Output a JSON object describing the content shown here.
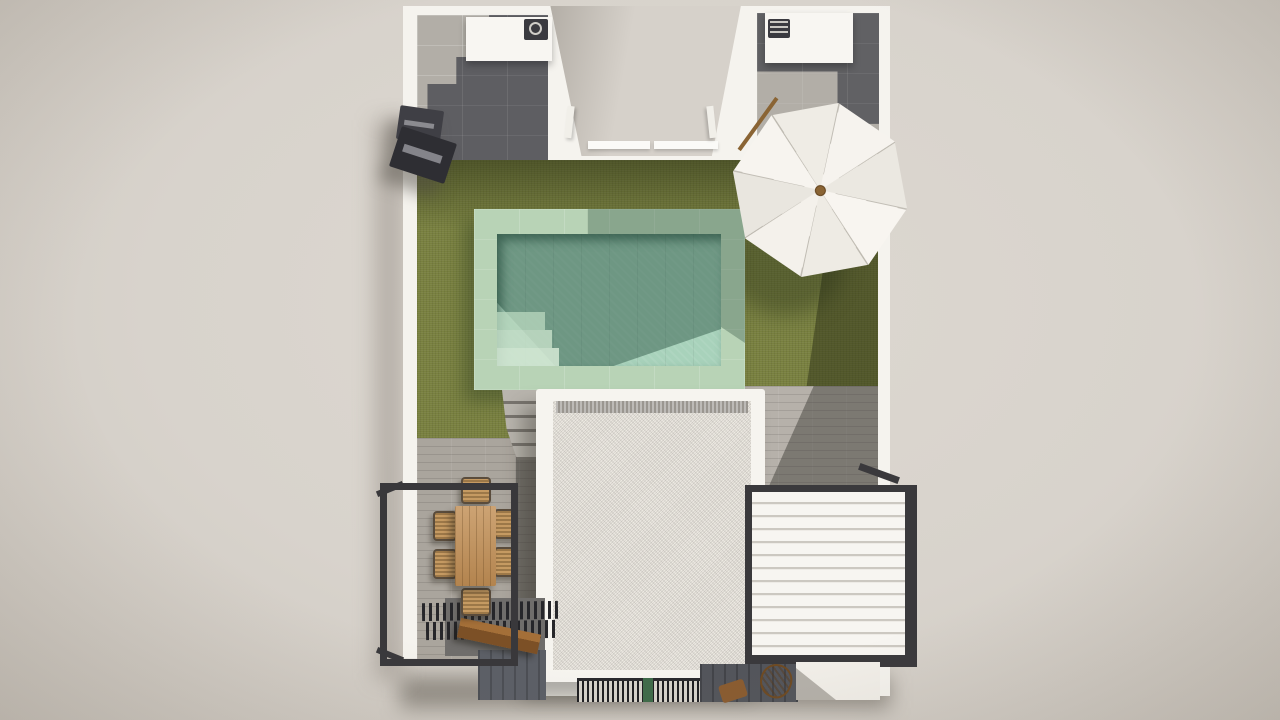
{
  "scene": {
    "type": "3d-architectural-render",
    "view": "top-down",
    "subject": "villa roof terrace with pool",
    "elements": [
      "outer-white-walls",
      "top-left-service-patio",
      "top-right-service-patio",
      "ac-unit-left",
      "ac-unit-right",
      "central-courtyard",
      "lawn",
      "swimming-pool",
      "pool-deck",
      "pool-steps",
      "parasol-umbrella",
      "garden-stairs",
      "gravel-roof",
      "left-balcony-railing",
      "dining-table",
      "dining-chairs",
      "pergola-slats",
      "wood-bench",
      "right-balcony-railing",
      "louvered-pergola",
      "floor-grate",
      "wood-stool",
      "wall-mounted-unit",
      "wood-pole"
    ],
    "counts": {
      "dining_chairs": 6,
      "umbrella_segments": 8,
      "pool_steps": 3
    }
  },
  "palette": {
    "background": "#d8d3cc",
    "wall_white": "#f5f3ee",
    "grass": "#78803f",
    "grass_shadow": "#4c5226",
    "pool_water": "#a8d2bb",
    "pool_water_shadow": "#5e8f7b",
    "pool_deck": "#b8d3b6",
    "tile_dark": "#57575c",
    "tile_light": "#b2aea7",
    "railing_metal": "#3a393c",
    "wood": "#c28f55",
    "wood_dark": "#7c5026",
    "louver_white": "#f7f5f1",
    "roof_gravel": "#edeae3",
    "plant_green": "#3f6b4a"
  }
}
